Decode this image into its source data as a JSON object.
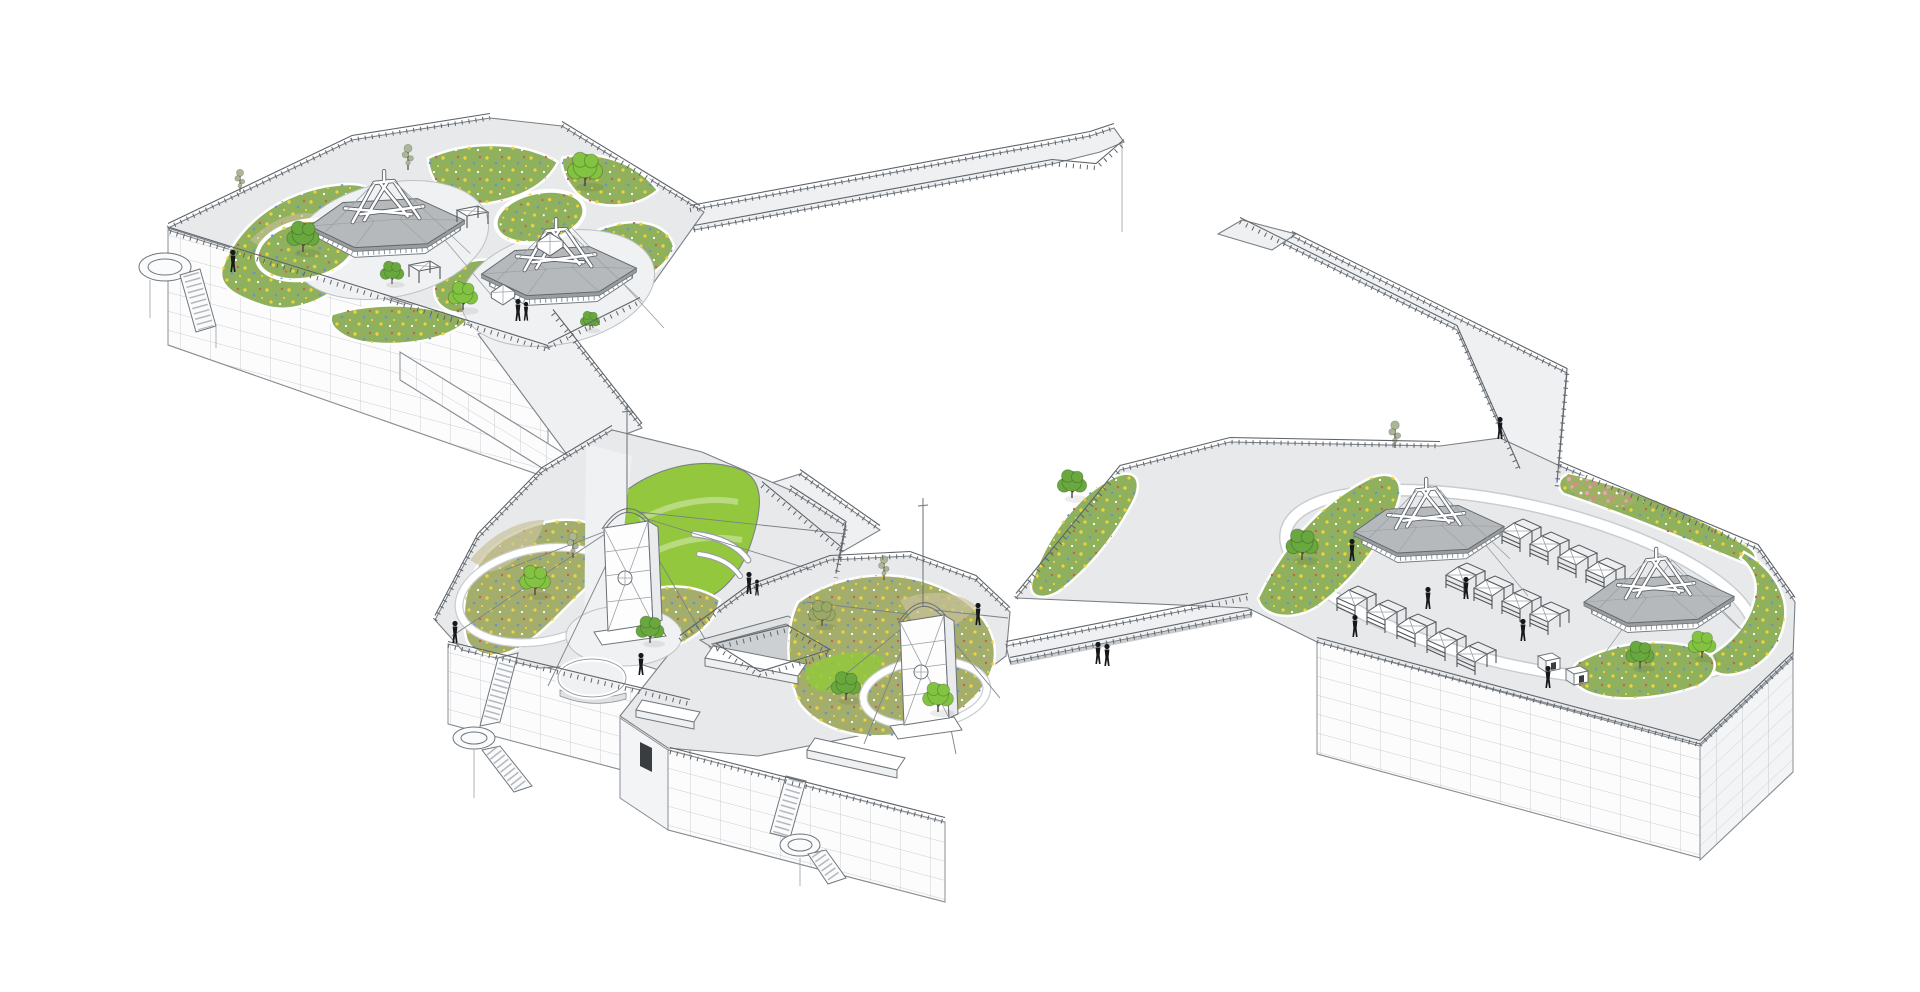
{
  "meta": {
    "title": "Axonometric architectural rendering of four connected rooftop parks with pavilions, lookout towers, market stalls and footbridges",
    "drawing_type": "axonometric line rendering with colored vegetation",
    "canvas": {
      "width": 1920,
      "height": 992
    }
  },
  "palette": {
    "background": "#ffffff",
    "line": "#5b6066",
    "rail": "#5f646a",
    "paving": "#e8e9eb",
    "paving_bright": "#eef0f2",
    "facade": "#fcfcfd",
    "facade_line": "#b9bec3",
    "roof": "#b5b9bc",
    "roof_edge": "#989da0",
    "lawn": "#93c83e",
    "meadow_green": "#8fb05c",
    "meadow_olive": "#a3ad6c",
    "grass_tan": "#c9c29b",
    "pink_bed": "#9eb064",
    "tree_bright": "#82c341",
    "tree_mid": "#68a83e",
    "tree_olive": "#9aa968",
    "tree_thin": "#aab694",
    "flower_yellow": "#eed23e",
    "flower_blue": "#6e8fd2",
    "flower_red": "#cc5f4c",
    "flower_white": "#ffffff",
    "flower_pink": "#ef9fb6",
    "flower_pink_deep": "#e87f9f",
    "figure": "#17181a"
  },
  "scene": {
    "platforms": [
      {
        "id": "northwest-garden-roof",
        "label": "Northwest garden roof",
        "pavilions": 2,
        "circular_plazas": 2,
        "ring_gardens": 2,
        "canopy_tents": 4,
        "trees": 7,
        "people": 3,
        "stairs": "west side stair with round landing",
        "features": [
          "wildflower meadow beds",
          "perimeter guardrail",
          "gridded curtain-wall facade"
        ]
      },
      {
        "id": "central-west-garden-roof",
        "label": "Central-west garden roof",
        "observation_towers": 1,
        "trees": 3,
        "people": 4,
        "curved_benches": 2,
        "lookout_balcony": 1,
        "stairs": "south stair with spiral landing",
        "features": [
          "guyed lookout tower with arched crown",
          "sloped lawn",
          "wildflower meadow",
          "gridded curtain-wall facade"
        ]
      },
      {
        "id": "central-east-garden-roof",
        "label": "Central-east garden roof",
        "observation_towers": 1,
        "skylights": 3,
        "trees": 4,
        "people": 1,
        "stairs": "south stair with spiral landing",
        "features": [
          "guyed lookout tower with arched crown",
          "sunken courtyard with guardrail",
          "semicircular meadow",
          "gridded curtain-wall facade"
        ]
      },
      {
        "id": "east-market-terrace",
        "label": "East market terrace",
        "pavilions": 2,
        "market_stall_rows": 3,
        "market_stalls": 13,
        "kiosks": 2,
        "trees": 5,
        "people": 6,
        "features": [
          "oval promenade loop",
          "perimeter wildflower border",
          "pink flower patch",
          "forked north access bridge",
          "gridded curtain-wall facade"
        ]
      }
    ],
    "connections": [
      {
        "id": "northeast-footbridge",
        "label": "Forked footbridge off northwest roof",
        "people": 0
      },
      {
        "id": "central-ramp",
        "label": "Ramp from northwest roof down to central-west roof",
        "people": 0
      },
      {
        "id": "central-link",
        "label": "Walkway with sunken courtyard between central roofs",
        "people": 0
      },
      {
        "id": "east-footbridge",
        "label": "Footbridge to east market terrace",
        "people": 2
      },
      {
        "id": "north-bridge-east",
        "label": "Forked north bridge onto east terrace",
        "people": 1
      }
    ],
    "people_total": 17,
    "trees_total": 19
  }
}
